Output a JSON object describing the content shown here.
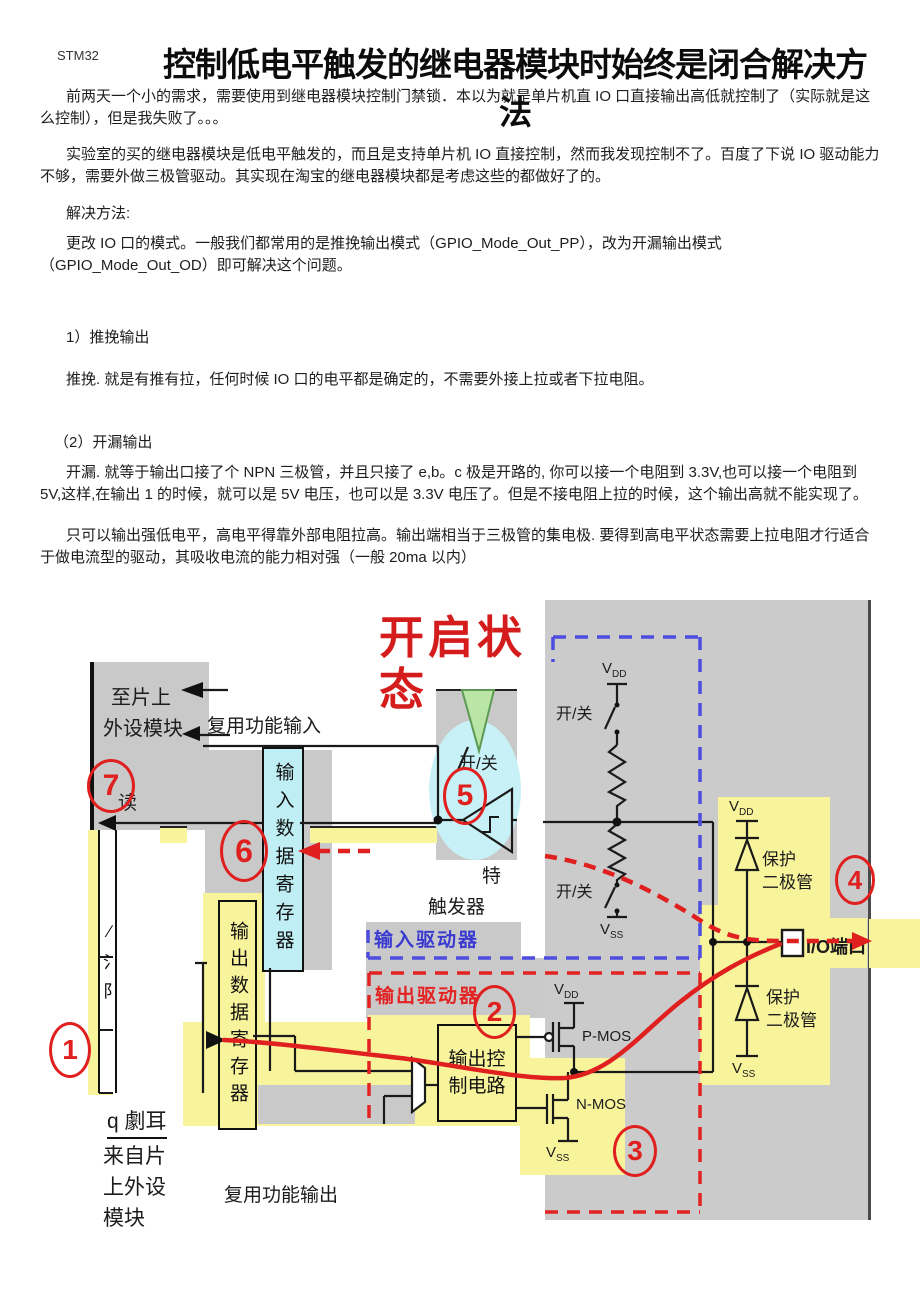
{
  "page": {
    "brand": "STM32",
    "title": "控制低电平触发的继电器模块时始终是闭合解决方法"
  },
  "paragraphs": {
    "p1": "前两天一个小的需求，需要使用到继电器模块控制门禁锁．本以为就是单片机直 IO 口直接输出高低就控制了（实际就是这么控制），但是我失败了。。。",
    "p2": "实验室的买的继电器模块是低电平触发的，而且是支持单片机 IO 直接控制，然而我发现控制不了。百度了下说 IO 驱动能力不够，需要外做三极管驱动。其实现在淘宝的继电器模块都是考虑这些的都做好了的。",
    "p3": "解决方法:",
    "p4": "更改 IO 口的模式。一般我们都常用的是推挽输出模式（GPIO_Mode_Out_PP），改为开漏输出模式（GPIO_Mode_Out_OD）即可解决这个问题。",
    "p5": "1）推挽输出",
    "p6": "推挽. 就是有推有拉，任何时候 IO 口的电平都是确定的，不需要外接上拉或者下拉电阻。",
    "p7": "（2）开漏输出",
    "p8": "开漏. 就等于输出口接了个 NPN 三极管，并且只接了 e,b。c 极是开路的, 你可以接一个电阻到 3.3V,也可以接一个电阻到 5V,这样,在输出 1 的时候，就可以是 5V 电压，也可以是 3.3V 电压了。但是不接电阻上拉的时候，这个输出高就不能实现了。",
    "p9": "只可以输出强低电平，高电平得靠外部电阻拉高。输出端相当于三极管的集电极. 要得到高电平状态需要上拉电阻才行适合于做电流型的驱动，其吸收电流的能力相对强（一般 20ma 以内）"
  },
  "diagram": {
    "open_state": "开启状态",
    "numbers": [
      "1",
      "2",
      "3",
      "4",
      "5",
      "6",
      "7"
    ],
    "labels": {
      "to_peripherals": [
        "至片上",
        "外设模块"
      ],
      "alt_func_input": "复用功能输入",
      "read": "读",
      "input_data_register": "输入数据寄存器",
      "output_data_register": "输出数据寄存器",
      "on_off": "开/关",
      "schmitt_partial": "特",
      "trigger": "触发器",
      "input_driver": "输入驱动器",
      "output_driver": "输出驱动器",
      "output_control": [
        "输出控",
        "制电路"
      ],
      "pmos": "P-MOS",
      "nmos": "N-MOS",
      "vdd": {
        "main": "V",
        "sub": "DD"
      },
      "vss": {
        "main": "V",
        "sub": "SS"
      },
      "protection_diode": [
        "保护",
        "二极管"
      ],
      "io_port": "I/O端口",
      "alt_func_output": "复用功能输出",
      "from_peripherals": "来自片上外设模块",
      "glitch_caption": "q 劇耳",
      "glitch_chars": "∕氵阝"
    },
    "colors": {
      "gray_panel": "#cbcbcb",
      "highlight_yellow": "#f8f49c",
      "register_cyan": "#bfeef4",
      "blob_cyan": "#c7f1f6",
      "triangle_green": "#b9e6a4",
      "annotation_red": "#e01f1f",
      "driver_blue": "#4d4de0",
      "wire_black": "#1a1a1a"
    }
  }
}
